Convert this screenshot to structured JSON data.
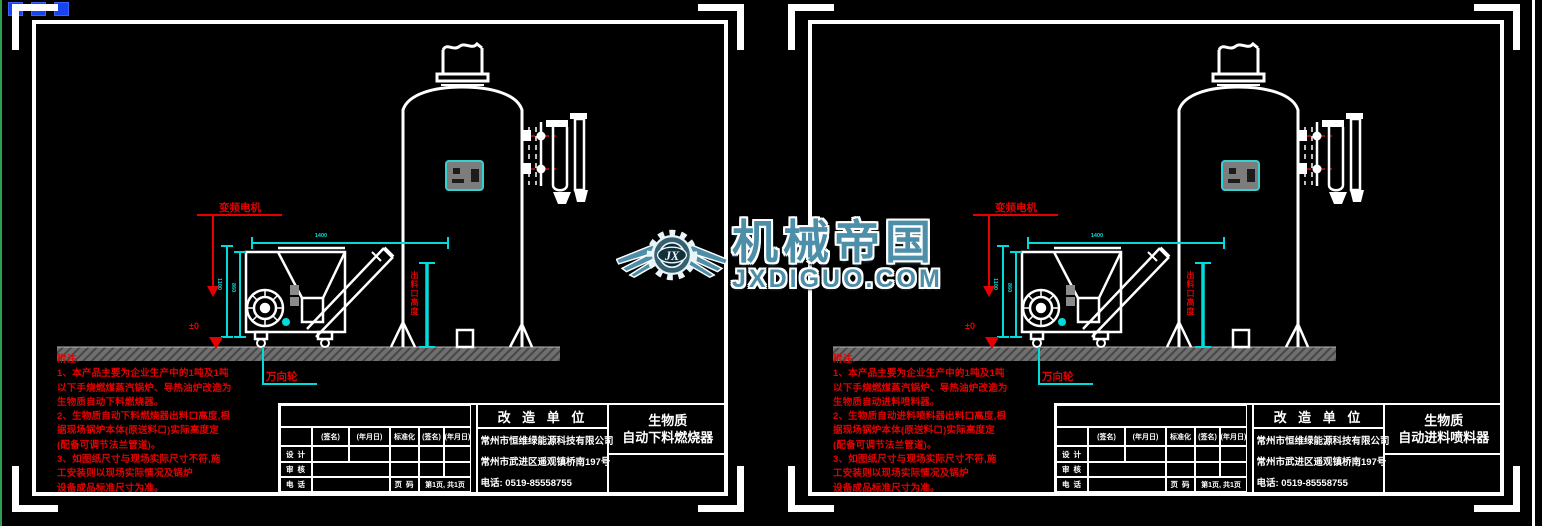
{
  "canvas": {
    "background": "#000000",
    "accent_cyan": "#00dcdc",
    "accent_red": "#e60000",
    "line_color": "#ffffff"
  },
  "icons": {
    "selection_grips": "grip-squares",
    "logo": "winged-gear-logo"
  },
  "watermark": {
    "brand": "机械帝国",
    "domain": "JXDIGUO.COM",
    "logo_initials": "JX",
    "color": "#4d8ea8"
  },
  "sheets": [
    {
      "drawing_labels": {
        "motor_label": "变频电机",
        "caster_label": "万向轮",
        "ground_level": "±0",
        "outlet_dim_label": "出料口高度"
      },
      "dimensions": {
        "width": "1400",
        "height_outer": "1100",
        "height_inner": "860"
      },
      "notes": [
        "附注:",
        "1、本产品主要为企业生产中的1吨及1吨",
        "以下手烧燃煤蒸汽锅炉、导热油炉改造为",
        "生物质自动下料燃烧器。",
        "2、生物质自动下料燃烧器出料口高度,根",
        "据现场锅炉本体(原送料口)实际高度定",
        "(配备可调节法兰管道)。",
        "3、如图纸尺寸与现场实际尺寸不符,施",
        "工安装则以现场实际情况及锅炉",
        "设备成品标准尺寸为准。"
      ],
      "title_block": {
        "sign_col_headers": [
          "(签名)",
          "(年月日)",
          "标准化",
          "(签名)",
          "(年月日)"
        ],
        "row_labels": [
          "设 计",
          "审 核",
          "电 话"
        ],
        "page_label": "页 码",
        "page_value": "第1页, 共1页",
        "unit_header": "改 造 单 位",
        "company_lines": [
          "常州市恒维绿能源科技有限公司",
          "常州市武进区遥观镇桥南197号",
          "电话: 0519-85558755"
        ],
        "product_lines": [
          "生物质",
          "自动下料燃烧器"
        ]
      }
    },
    {
      "drawing_labels": {
        "motor_label": "变频电机",
        "caster_label": "万向轮",
        "ground_level": "±0",
        "outlet_dim_label": "出料口高度"
      },
      "dimensions": {
        "width": "1400",
        "height_outer": "1100",
        "height_inner": "860"
      },
      "notes": [
        "附注:",
        "1、本产品主要为企业生产中的1吨及1吨",
        "以下手烧燃煤蒸汽锅炉、导热油炉改造为",
        "生物质自动进料喷料器。",
        "2、生物质自动进料喷料器出料口高度,根",
        "据现场锅炉本体(原送料口)实际高度定",
        "(配备可调节法兰管道)。",
        "3、如图纸尺寸与现场实际尺寸不符,施",
        "工安装则以现场实际情况及锅炉",
        "设备成品标准尺寸为准。"
      ],
      "title_block": {
        "sign_col_headers": [
          "(签名)",
          "(年月日)",
          "标准化",
          "(签名)",
          "(年月日)"
        ],
        "row_labels": [
          "设 计",
          "审 核",
          "电 话"
        ],
        "page_label": "页 码",
        "page_value": "第1页, 共1页",
        "unit_header": "改 造 单 位",
        "company_lines": [
          "常州市恒维绿能源科技有限公司",
          "常州市武进区遥观镇桥南197号",
          "电话: 0519-85558755"
        ],
        "product_lines": [
          "生物质",
          "自动进料喷料器"
        ]
      }
    }
  ]
}
